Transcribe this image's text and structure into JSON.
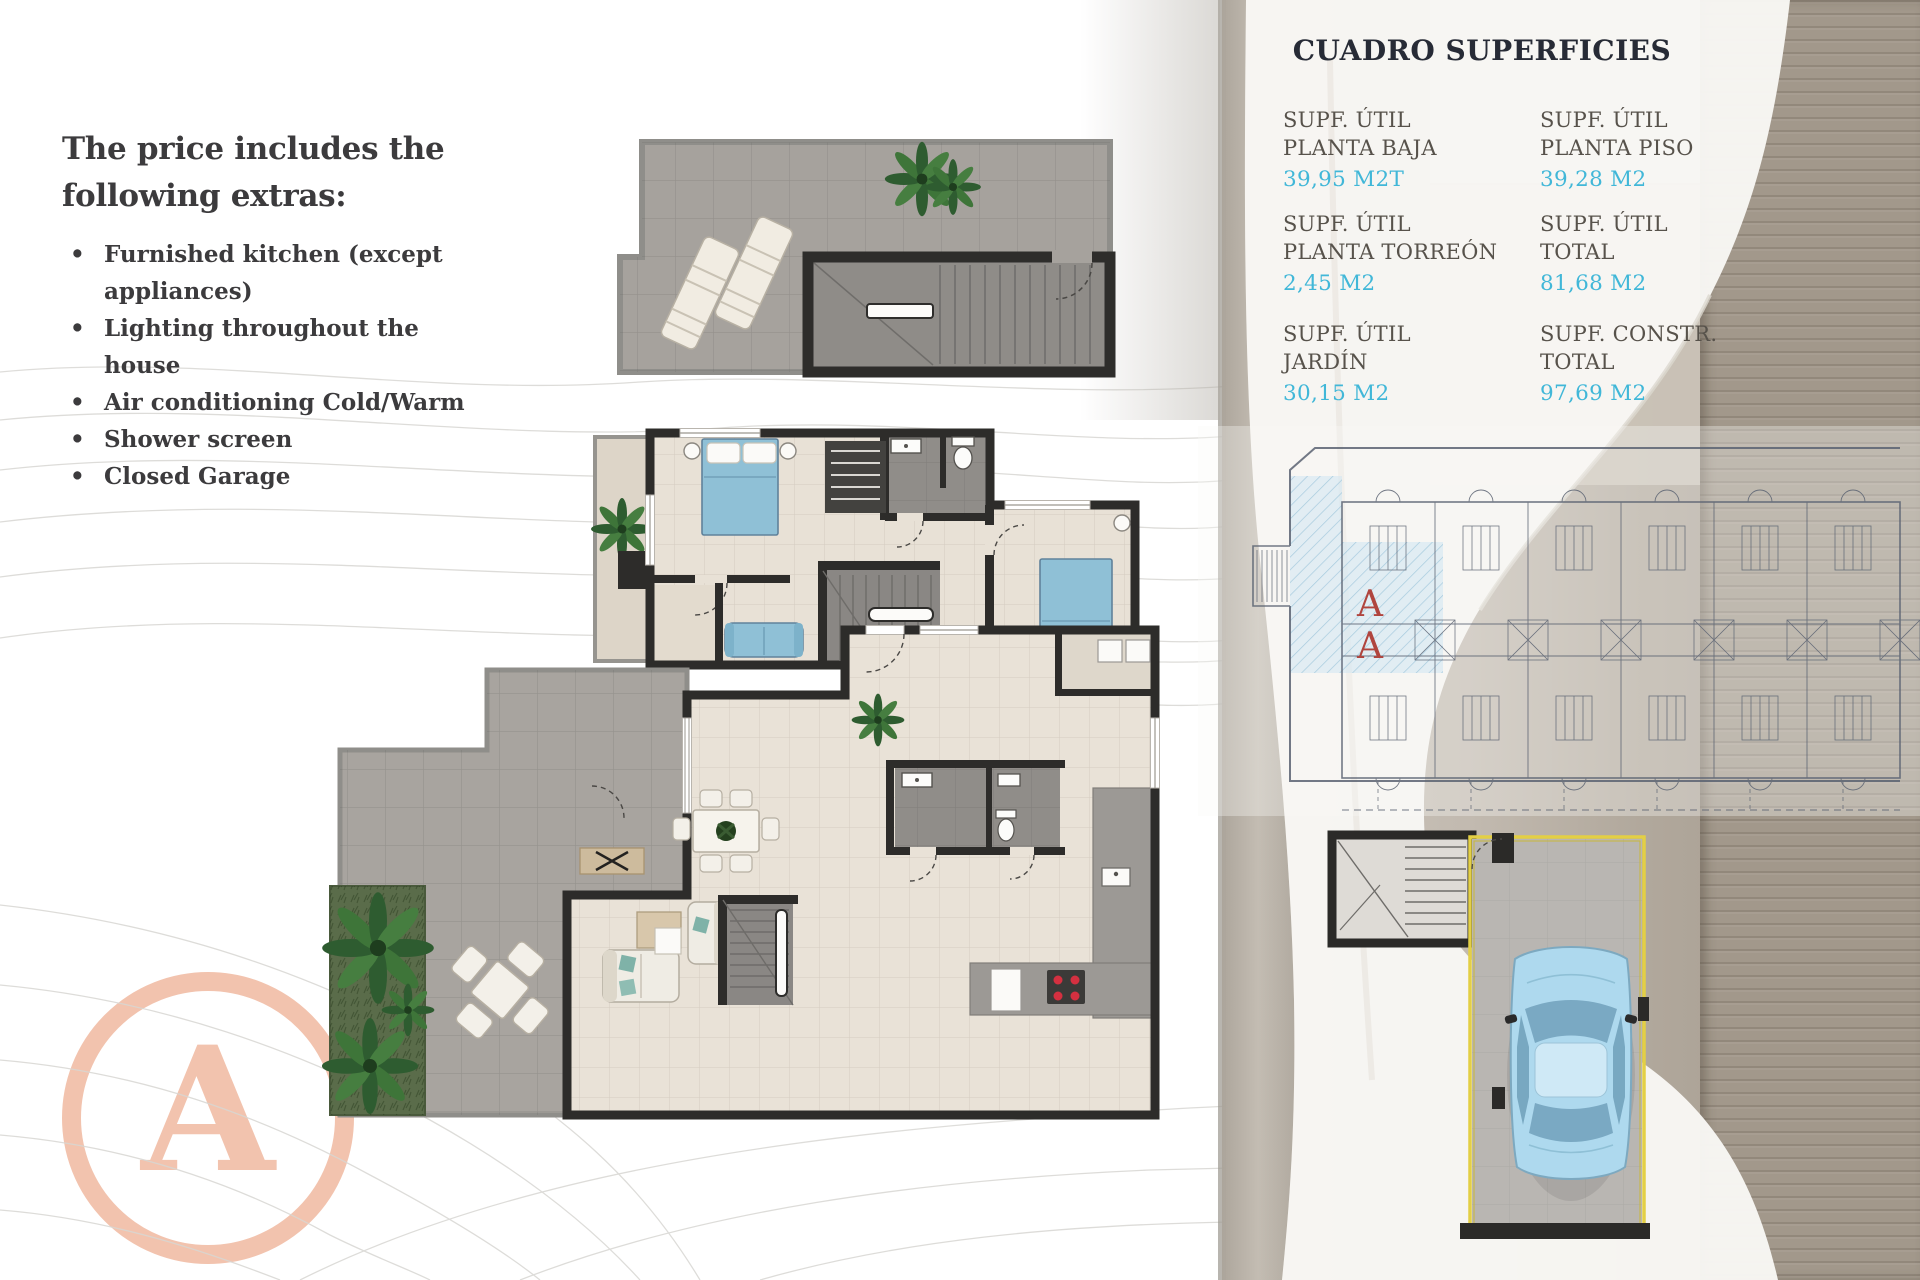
{
  "left_panel": {
    "title_line1": "The price includes the",
    "title_line2": "following extras:",
    "bullets": [
      "Furnished kitchen (except appliances)",
      "Lighting throughout the house",
      "Air conditioning Cold/Warm",
      "Shower screen",
      "Closed Garage"
    ]
  },
  "surfaces_table": {
    "title": "CUADRO SUPERFICIES",
    "entries": [
      {
        "line1": "SUPF. ÚTIL",
        "line2": "PLANTA BAJA",
        "value": "39,95 M2T"
      },
      {
        "line1": "SUPF. ÚTIL",
        "line2": "PLANTA PISO",
        "value": "39,28 M2"
      },
      {
        "line1": "SUPF. ÚTIL",
        "line2": "PLANTA TORREÓN",
        "value": "2,45 M2"
      },
      {
        "line1": "SUPF. ÚTIL",
        "line2": "TOTAL",
        "value": "81,68 M2"
      },
      {
        "line1": "SUPF. ÚTIL",
        "line2": "JARDÍN",
        "value": "30,15 M2"
      },
      {
        "line1": "SUPF. CONSTR.",
        "line2": "TOTAL",
        "value": "97,69 M2"
      }
    ]
  },
  "site_plan": {
    "unit_marker_top": "A",
    "unit_marker_bottom": "A"
  },
  "logo": {
    "letter": "A"
  },
  "colors": {
    "accent_cyan": "#41b7d8",
    "label_brown": "#57524b",
    "logo_salmon": "#f2c3ae",
    "unit_marker_red": "#b0453e",
    "garage_outline_yellow": "#e3cf45",
    "highlight_blue": "#cfe6f2"
  }
}
